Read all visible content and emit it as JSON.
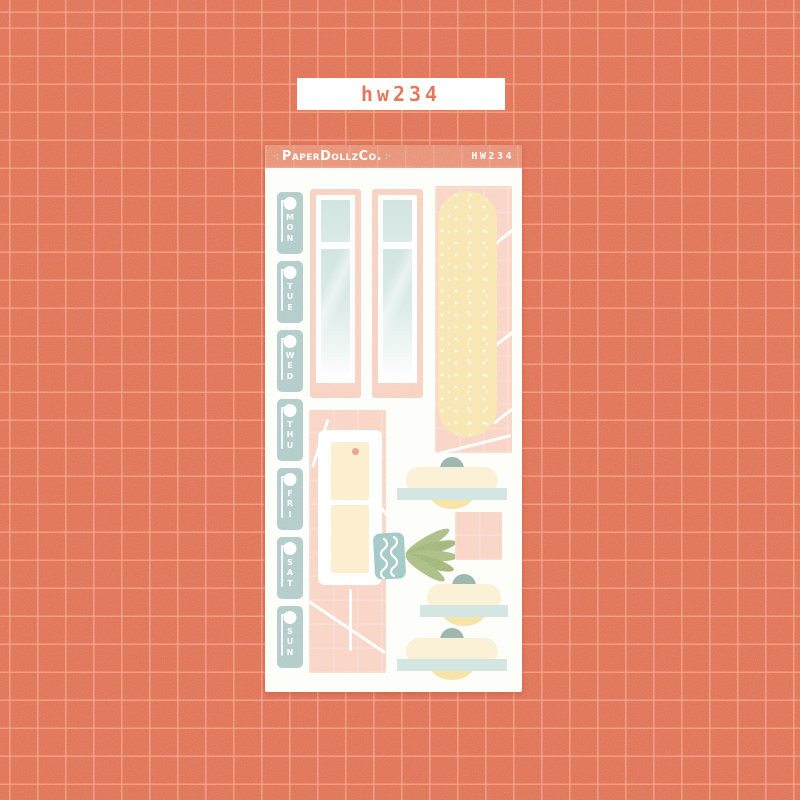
{
  "backdrop": {
    "base_color": "#df6e55",
    "grid_line_color": "#f2a88e"
  },
  "sku_label": {
    "text": "hw234",
    "text_color": "#de6e55",
    "background": "#ffffff"
  },
  "sheet": {
    "background": "#fdfdfa",
    "header": {
      "decor_left": "·:",
      "brand": "PaperDollzCo.",
      "decor_right": ":·",
      "sku": "HW234",
      "background": "#e78c72",
      "text_color": "#ffffff"
    },
    "days": [
      "MON",
      "TUE",
      "WED",
      "THU",
      "FRI",
      "SAT",
      "SUN"
    ],
    "sticker_names": [
      "weekday-tab-mon",
      "weekday-tab-tue",
      "weekday-tab-wed",
      "weekday-tab-thu",
      "weekday-tab-fri",
      "weekday-tab-sat",
      "weekday-tab-sun",
      "window-scene",
      "speckled-capsule-on-tiles",
      "cabinet-on-tiles",
      "potted-plant",
      "cloche-dish-top",
      "peach-tile-square",
      "cloche-dish-middle",
      "cloche-dish-bottom"
    ],
    "palette": {
      "day_sticker_teal": "#adc9c6",
      "peach_tile": "#f9d2c2",
      "window_frame_peach": "#f7cfbe",
      "window_glass_teal": "#cde2de",
      "capsule_yellow": "#f8e5ac",
      "cabinet_cream": "#fbeeca",
      "cabinet_knob_pink": "#f0998c",
      "plant_pot_teal": "#9cc5c2",
      "leaf_green": "#a5ba7e",
      "cloche_dome_cream": "#faf1d6",
      "cloche_knob_teal": "#9db8b1",
      "cloche_shelf_teal": "#d4e6e2",
      "cake_yellow": "#f8e3a8"
    }
  }
}
